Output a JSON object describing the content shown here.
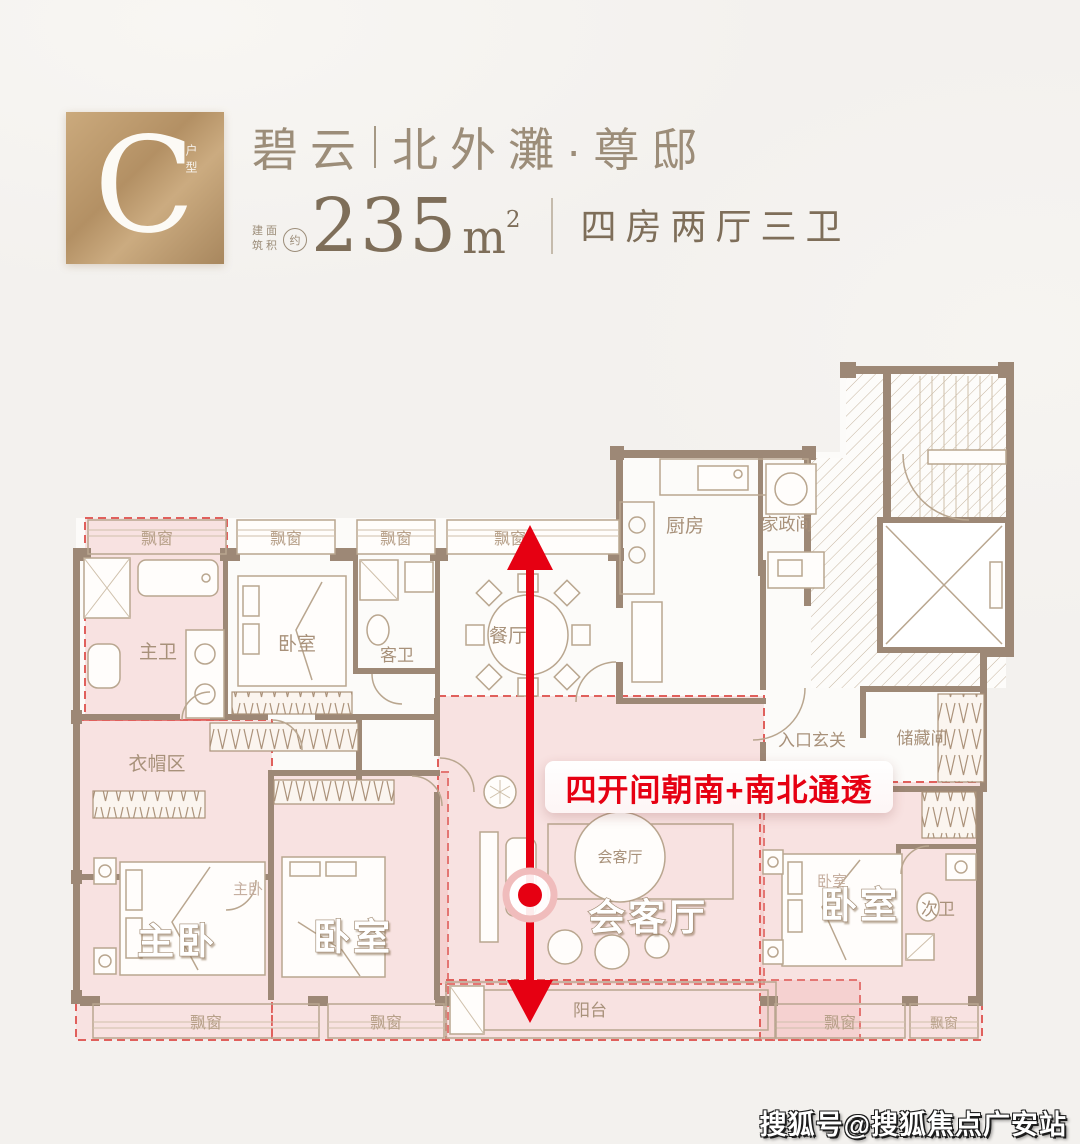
{
  "header": {
    "badge": {
      "letter": "C",
      "side_label": "户型"
    },
    "title": {
      "left": "碧云",
      "divider": "",
      "right": "北外灘·尊邸"
    },
    "area": {
      "prefix_chars": [
        "建",
        "筑",
        "面",
        "积"
      ],
      "approx": "约",
      "value": "235",
      "unit": "m",
      "unit_sup": "2"
    },
    "layout_text": "四房两厅三卫"
  },
  "plan": {
    "labels": {
      "bay_window": "飘窗",
      "master_bath": "主卫",
      "bedroom": "卧室",
      "guest_bath": "客卫",
      "dining": "餐厅",
      "kitchen": "厨房",
      "laundry": "家政间",
      "entry": "入口玄关",
      "storage": "储藏间",
      "cloakroom": "衣帽区",
      "master_bedroom": "主卧",
      "living": "会客厅",
      "balcony": "阳台",
      "second_bath": "次卫"
    },
    "highlight_label": "四开间朝南+南北通透"
  },
  "watermark": "搜狐号@搜狐焦点广安站",
  "colors": {
    "gold": "#b99a6d",
    "wall": "#9d8876",
    "pink_fill": "#f2d8d6",
    "red": "#e60012",
    "dash_red": "#e0605c",
    "text_brown": "#9b8c77"
  }
}
